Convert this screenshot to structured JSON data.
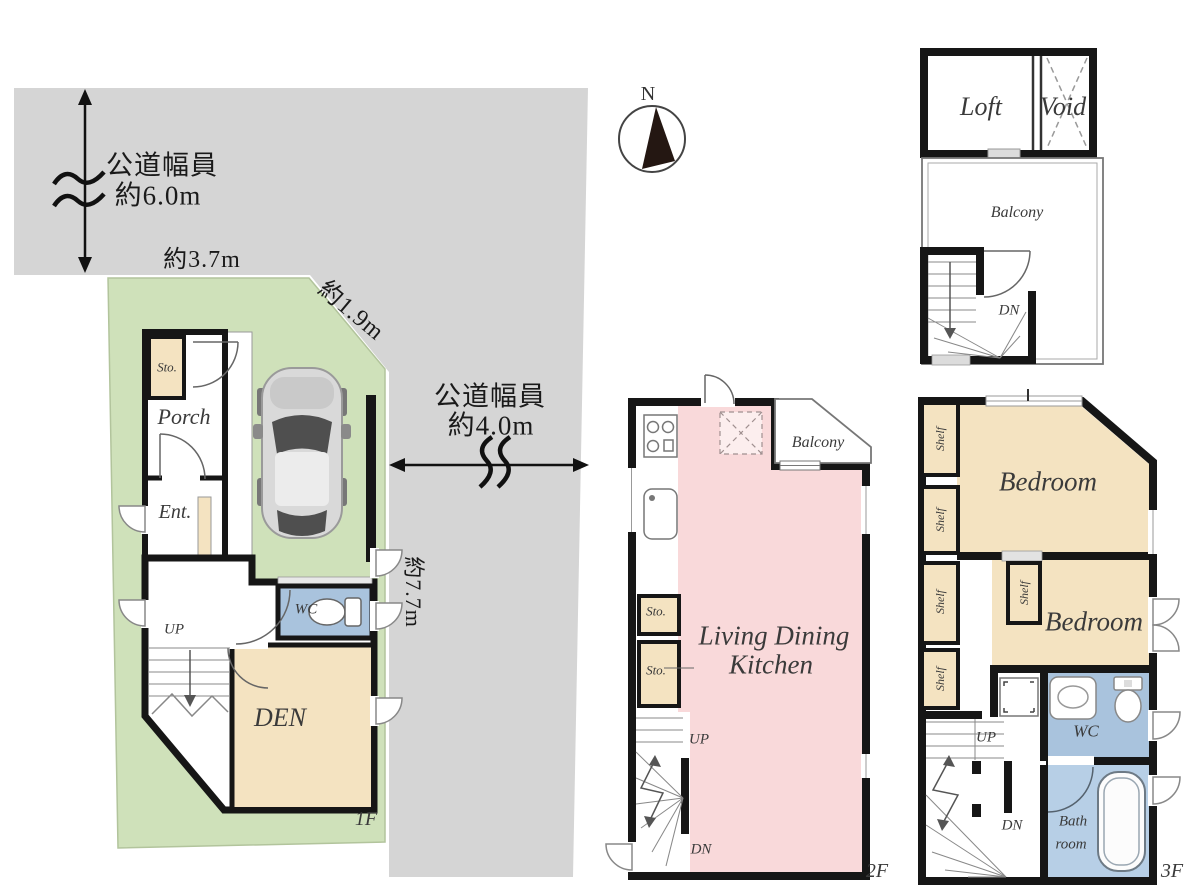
{
  "title": "Floor plan set: site/1F, 2F, 3F and Loft",
  "colors": {
    "road_gray": "#d5d5d5",
    "lot_green": "#cfe1ba",
    "room_tan": "#f4e3c1",
    "ldk_pink": "#f9d9da",
    "wc_blue": "#a9c3dd",
    "bath_blue": "#b7cfe6",
    "wall_black": "#161616"
  },
  "compass": {
    "north": "N"
  },
  "site_plan": {
    "road_top": {
      "line1": "公道幅員",
      "line2": "約6.0m"
    },
    "road_right": {
      "line1": "公道幅員",
      "line2": "約4.0m"
    },
    "dims": {
      "frontage": "約3.7m",
      "corner": "約1.9m",
      "depth": "約7.7m"
    },
    "floor_label": "1F",
    "rooms": {
      "storage": "Sto.",
      "porch": "Porch",
      "entrance": "Ent.",
      "stairs_up": "UP",
      "toilet": "WC",
      "den": "DEN"
    }
  },
  "floor_2": {
    "floor_label": "2F",
    "rooms": {
      "ldk_line1": "Living Dining",
      "ldk_line2": "Kitchen",
      "balcony": "Balcony",
      "storage_1": "Sto.",
      "storage_2": "Sto.",
      "stairs_up": "UP",
      "stairs_down": "DN"
    }
  },
  "floor_3": {
    "floor_label": "3F",
    "rooms": {
      "bedroom_1": "Bedroom",
      "bedroom_2": "Bedroom",
      "toilet": "WC",
      "bath_line1": "Bath",
      "bath_line2": "room",
      "stairs_up": "UP",
      "stairs_down": "DN",
      "shelf_1": "Shelf",
      "shelf_2": "Shelf",
      "shelf_3": "Shelf",
      "shelf_4": "Shelf",
      "shelf_5": "Shelf"
    }
  },
  "loft": {
    "rooms": {
      "loft": "Loft",
      "void": "Void",
      "balcony": "Balcony",
      "stairs_down": "DN"
    }
  }
}
